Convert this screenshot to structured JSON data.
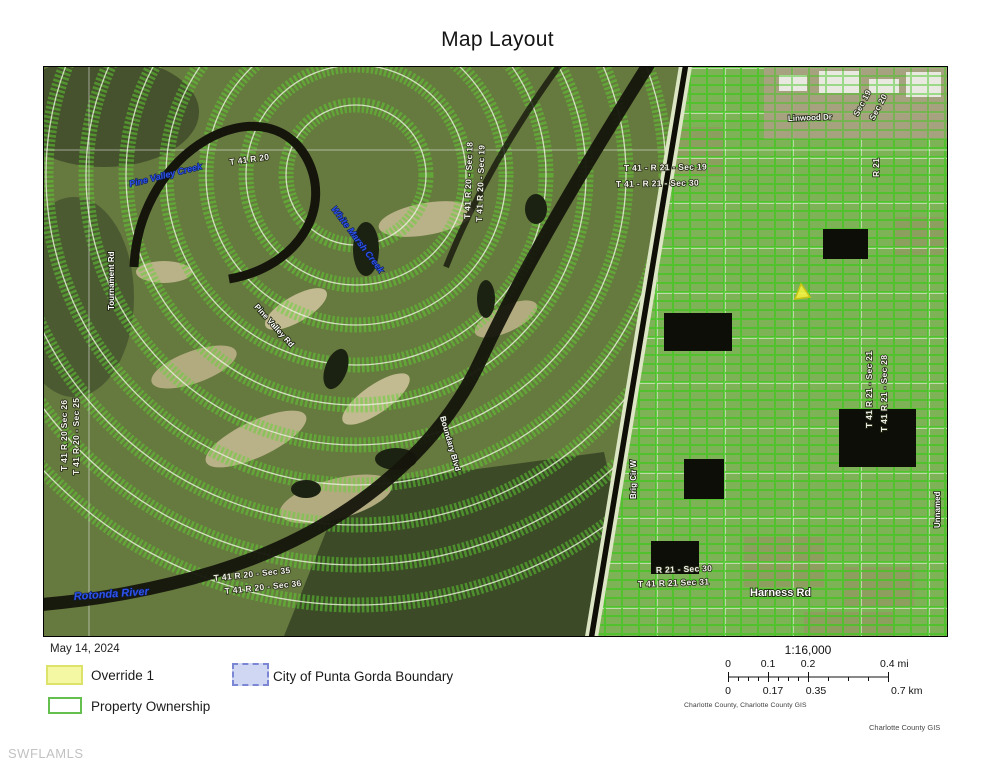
{
  "page": {
    "title": "Map Layout"
  },
  "map": {
    "labels": [
      {
        "text": "Pine Valley Creek",
        "kind": "water"
      },
      {
        "text": "White Marsh Creek",
        "kind": "water"
      },
      {
        "text": "Rotonda River",
        "kind": "water"
      },
      {
        "text": "Tournament Rd",
        "kind": "road"
      },
      {
        "text": "Boundary Blvd",
        "kind": "road"
      },
      {
        "text": "Pine Valley Rd",
        "kind": "road"
      },
      {
        "text": "Harness Rd",
        "kind": "road"
      },
      {
        "text": "Linwood Dr",
        "kind": "road"
      },
      {
        "text": "Brig Cir W",
        "kind": "road"
      },
      {
        "text": "Unnamed",
        "kind": "road"
      },
      {
        "text": "T 41 - R 21 - Sec 19",
        "kind": "section"
      },
      {
        "text": "T 41 - R 21 - Sec 30",
        "kind": "section"
      },
      {
        "text": "T 41 R 21 - Sec 21",
        "kind": "section"
      },
      {
        "text": "T 41 R 21 - Sec 28",
        "kind": "section"
      },
      {
        "text": "T 41 R 20 - Sec 18",
        "kind": "section"
      },
      {
        "text": "T 41 R 20 - Sec 19",
        "kind": "section"
      },
      {
        "text": "T 41 R 20 - Sec 35",
        "kind": "section"
      },
      {
        "text": "T 41 R 20 - Sec 36",
        "kind": "section"
      },
      {
        "text": "R 21 - Sec 30",
        "kind": "section"
      },
      {
        "text": "T 41 R 21 Sec 31",
        "kind": "section"
      },
      {
        "text": "Sec 19",
        "kind": "section"
      },
      {
        "text": "Sec 20",
        "kind": "section"
      },
      {
        "text": "R 21",
        "kind": "section"
      },
      {
        "text": "T 41 R 20 Sec 26",
        "kind": "section"
      },
      {
        "text": "T 41 R 20 - Sec 25",
        "kind": "section"
      },
      {
        "text": "T 41 R 20",
        "kind": "section"
      }
    ],
    "marker": {
      "name": "override-triangle"
    }
  },
  "legend": {
    "date": "May 14, 2024",
    "items": [
      {
        "label": "Override 1",
        "swatch": "yellow-fill"
      },
      {
        "label": "City of Punta Gorda Boundary",
        "swatch": "blue-dashed"
      },
      {
        "label": "Property Ownership",
        "swatch": "green-outline"
      }
    ]
  },
  "scalebar": {
    "ratio": "1:16,000",
    "mi_ticks": [
      "0",
      "0.1",
      "0.2",
      "0.4 mi"
    ],
    "km_ticks": [
      "0",
      "0.17",
      "0.35",
      "0.7 km"
    ],
    "attribution": "Charlotte County, Charlotte County GIS"
  },
  "footer": {
    "watermark": "SWFLAMLS",
    "credit": "Charlotte County GIS"
  },
  "colors": {
    "parcel_line": "#46c524",
    "override_fill": "#f4f8a2",
    "override_border": "#dde26b",
    "city_boundary_fill": "#cfd7f2",
    "city_boundary_border": "#7b87d4",
    "ownership_border": "#64bf4e",
    "water_label": "#2f52e8",
    "pond": "#0c0e07"
  }
}
